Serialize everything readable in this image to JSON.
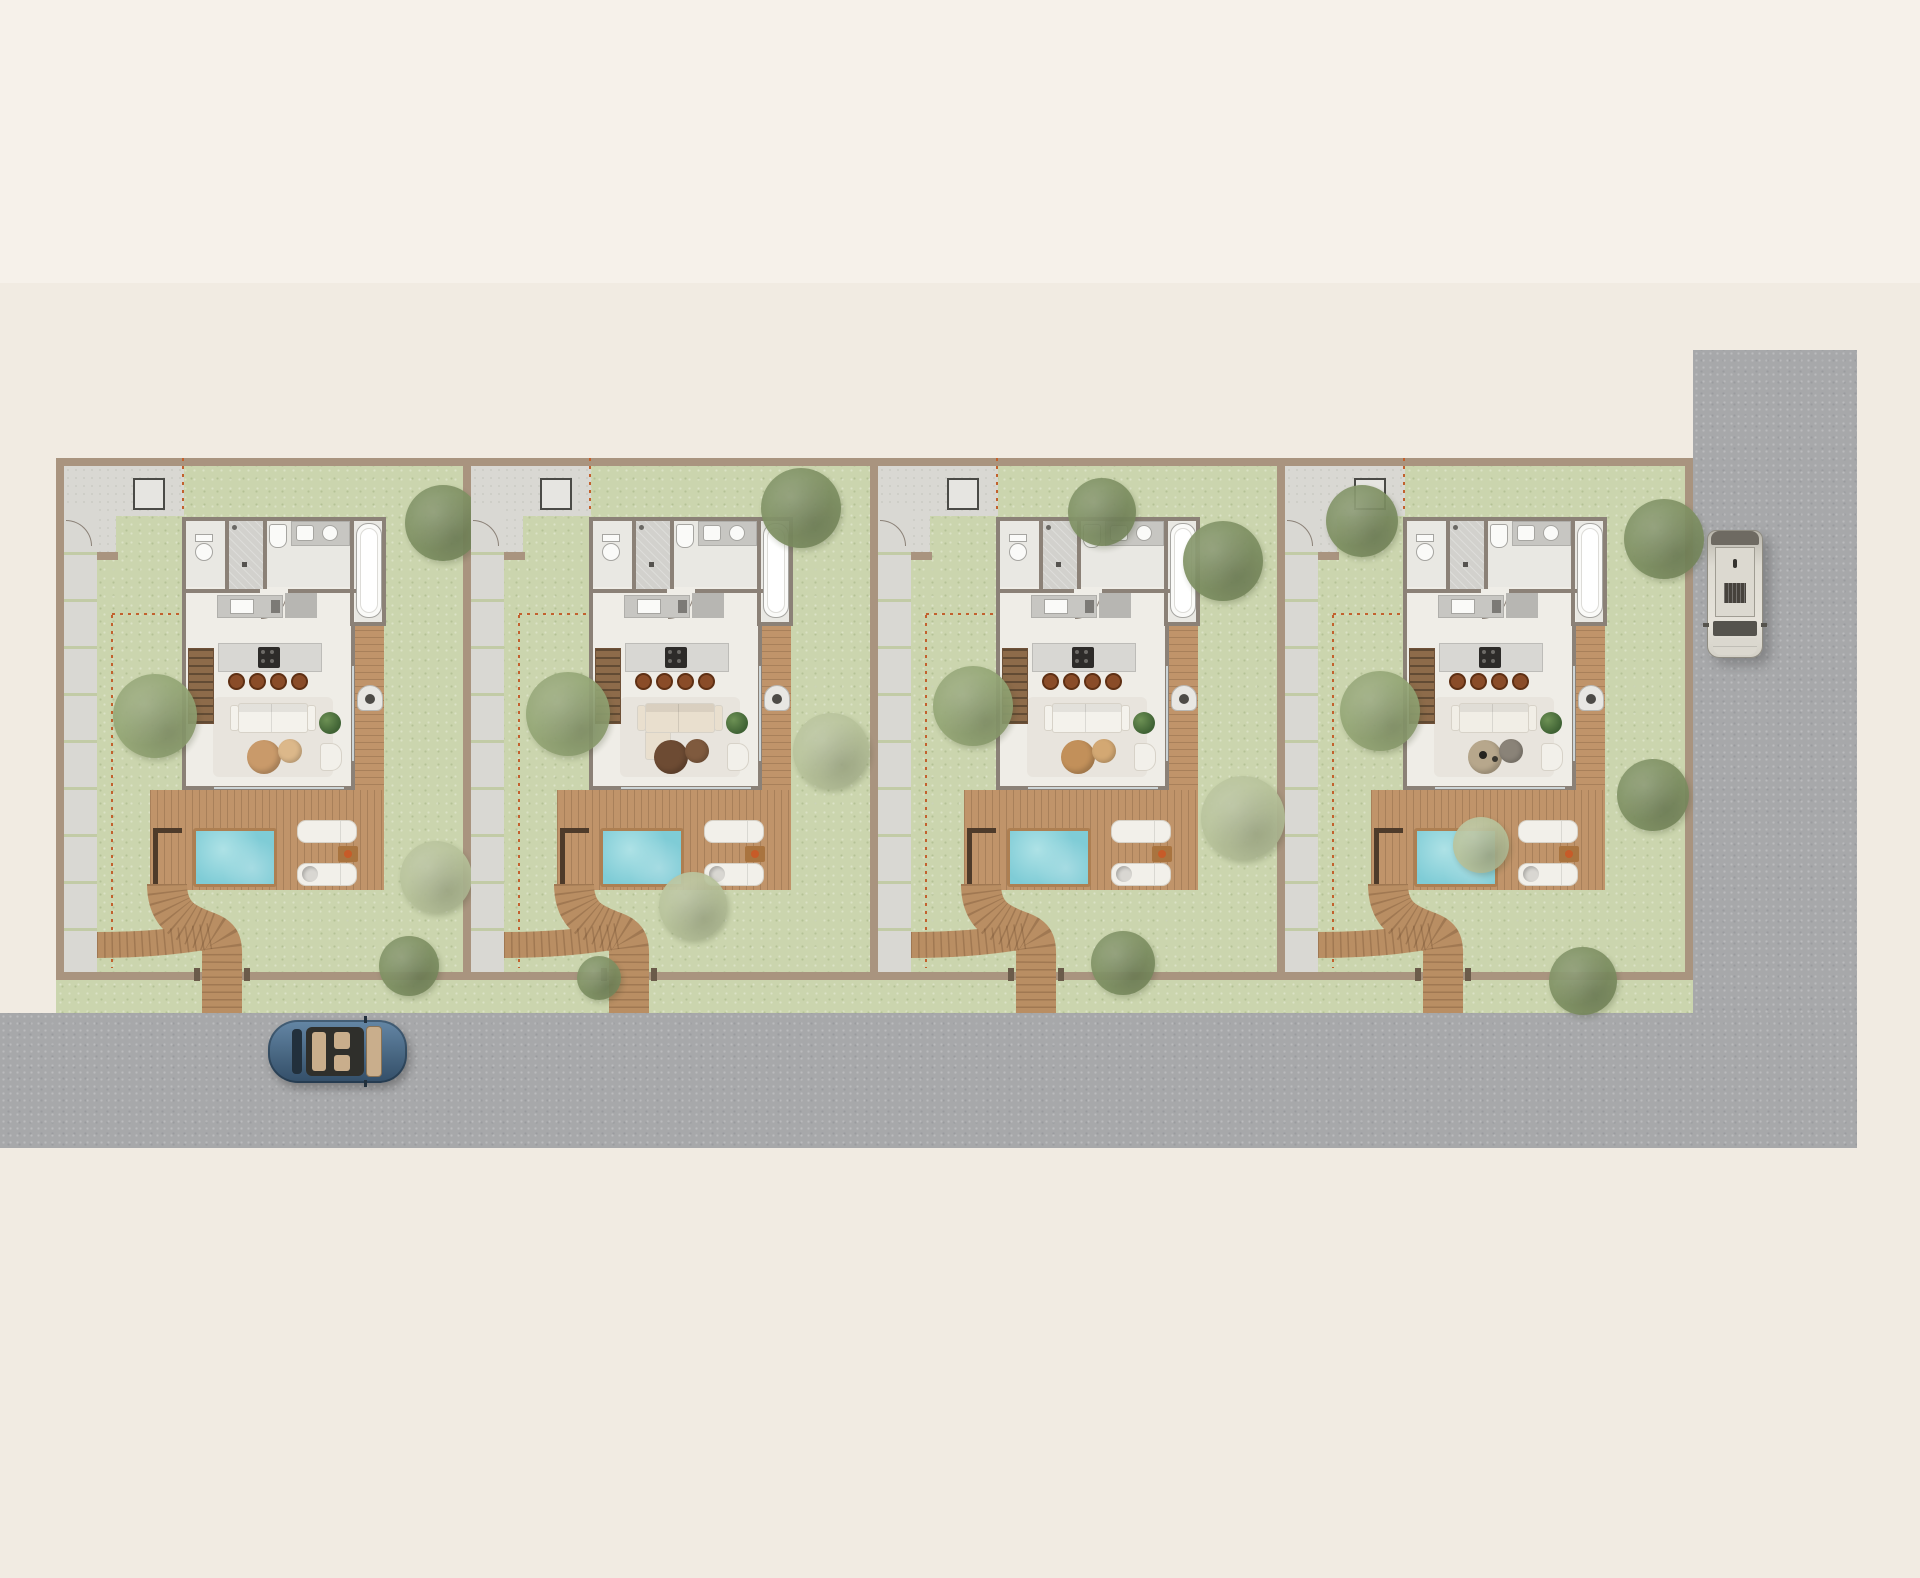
{
  "scene": {
    "kind": "architectural-site-plan-top-view",
    "width": 1920,
    "height": 1578,
    "villa_count": 4
  },
  "palette": {
    "background": "#f1ebe2",
    "background_top": "#f6f1ea",
    "road": "#a7a8aa",
    "grass": "#cbd5ae",
    "wall": "#a9947f",
    "inner_wall": "#8b8177",
    "paving": "#d9d8d3",
    "bath_floor": "#e9e8e3",
    "living_floor": "#efede7",
    "tile": "#d2d1cd",
    "counter": "#c7c6c2",
    "counter_dark": "#b7b6b2",
    "island": "#d8d7d3",
    "cooktop": "#2d2b29",
    "wood": "#c0946a",
    "wood_stair": "#8d6b4a",
    "walkway": "#b98e63",
    "pergola": "#4e3b2a",
    "pool_water": "#7fccd6",
    "pool_water_light": "#aee2e6",
    "pool_rim": "#ad7f52",
    "white_furniture": "#f2f0ea",
    "furniture_line": "#d7d2c8",
    "stool": "#8a4c28",
    "plant": "#4c7040",
    "dash_line": "#c2612e",
    "tree_dark": "#7e9062",
    "tree_mid": "#93a574",
    "tree_pale": "#b7c29a",
    "window_glass": "#ccd4d6",
    "car_body": "#46647f",
    "car_body_light": "#6587a6",
    "car_glass": "#22303c",
    "car_interior": "#c9ae8c",
    "van_body": "#dedbd2",
    "van_roof": "#6e6a62",
    "van_glass": "#55534d",
    "fixture_white": "#fafaf8",
    "fixture_line": "#a6a5a1"
  },
  "site": {
    "top_band_height": 283,
    "compound": {
      "x": 56,
      "y": 458,
      "w": 1637,
      "h": 522,
      "wall": 8
    },
    "grass_strip": {
      "x": 56,
      "y": 980,
      "w": 1637,
      "h": 33
    },
    "bottom_road": {
      "x": 0,
      "y": 1013,
      "w": 1857,
      "h": 135
    },
    "right_road": {
      "x": 1693,
      "y": 350,
      "w": 164,
      "h": 798
    },
    "villa_top": 466,
    "villa_w": 399,
    "villa_h": 547,
    "dividers": [
      463,
      870,
      1277
    ]
  },
  "villas": [
    {
      "id": "villa-1",
      "x": 64,
      "sofa_color": "#f4f2ec",
      "sofa_variant": "straight",
      "table_color": "#c99a6a",
      "table2_color": "#dcb88a",
      "decor": false,
      "trees": [
        {
          "x": 379,
          "y": 57,
          "r": 38,
          "shade": "dark"
        },
        {
          "x": 91,
          "y": 250,
          "r": 42,
          "shade": "mid"
        },
        {
          "x": 372,
          "y": 411,
          "r": 36,
          "shade": "pale"
        },
        {
          "x": 345,
          "y": 500,
          "r": 30,
          "shade": "dark"
        }
      ]
    },
    {
      "id": "villa-2",
      "x": 471,
      "sofa_color": "#e9dfce",
      "sofa_variant": "l-shape",
      "table_color": "#6d4b33",
      "table2_color": "#7f5a3e",
      "decor": false,
      "trees": [
        {
          "x": 330,
          "y": 42,
          "r": 40,
          "shade": "dark"
        },
        {
          "x": 97,
          "y": 248,
          "r": 42,
          "shade": "mid"
        },
        {
          "x": 360,
          "y": 285,
          "r": 38,
          "shade": "pale"
        },
        {
          "x": 222,
          "y": 440,
          "r": 34,
          "shade": "pale"
        },
        {
          "x": 128,
          "y": 512,
          "r": 22,
          "shade": "dark"
        }
      ]
    },
    {
      "id": "villa-3",
      "x": 878,
      "sofa_color": "#f4f2ec",
      "sofa_variant": "straight",
      "table_color": "#c2905a",
      "table2_color": "#d3a873",
      "decor": false,
      "trees": [
        {
          "x": 224,
          "y": 46,
          "r": 34,
          "shade": "dark"
        },
        {
          "x": 345,
          "y": 95,
          "r": 40,
          "shade": "dark"
        },
        {
          "x": 95,
          "y": 240,
          "r": 40,
          "shade": "mid"
        },
        {
          "x": 365,
          "y": 352,
          "r": 42,
          "shade": "pale"
        },
        {
          "x": 245,
          "y": 497,
          "r": 32,
          "shade": "dark"
        }
      ]
    },
    {
      "id": "villa-4",
      "x": 1285,
      "sofa_color": "#f1eee6",
      "sofa_variant": "straight",
      "table_color": "#b7a78c",
      "table2_color": "#8a8378",
      "decor": true,
      "trees": [
        {
          "x": 77,
          "y": 55,
          "r": 36,
          "shade": "dark"
        },
        {
          "x": 379,
          "y": 73,
          "r": 40,
          "shade": "dark"
        },
        {
          "x": 95,
          "y": 245,
          "r": 40,
          "shade": "mid"
        },
        {
          "x": 368,
          "y": 329,
          "r": 36,
          "shade": "dark"
        },
        {
          "x": 196,
          "y": 379,
          "r": 28,
          "shade": "pale"
        },
        {
          "x": 298,
          "y": 515,
          "r": 34,
          "shade": "dark"
        }
      ]
    }
  ],
  "vehicles": {
    "car": {
      "x": 268,
      "y": 1020,
      "w": 139,
      "h": 63,
      "heading": "east"
    },
    "van": {
      "x": 1707,
      "y": 530,
      "w": 56,
      "h": 128,
      "heading": "south"
    }
  }
}
